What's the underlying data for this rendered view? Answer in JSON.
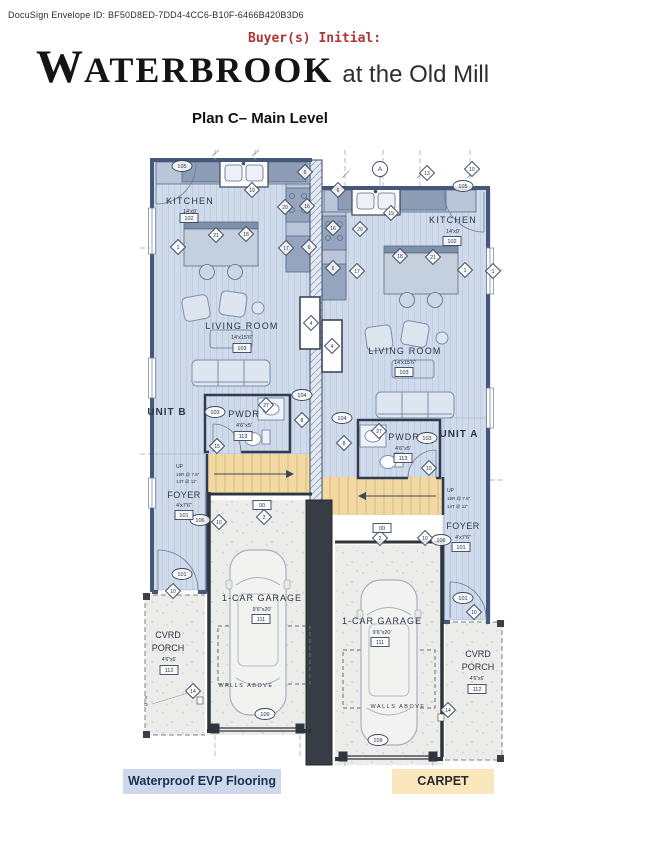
{
  "header": {
    "envelope_id": "DocuSign Envelope ID: BF50D8ED-7DD4-4CC6-B10F-6466B420B3D6",
    "buyer_initial_label": "Buyer(s) Initial:",
    "brand_initial": "W",
    "brand_rest": "ATERBROOK",
    "brand_subtitle": "at the Old Mill",
    "plan_title": "Plan C– Main Level"
  },
  "legend": {
    "evp_label": "Waterproof EVP Flooring",
    "carpet_label": "CARPET"
  },
  "colors": {
    "evp_floor": "#cfdaea",
    "carpet_stairs": "#f2d9a2",
    "legend_evp_bg": "#ccd9ed",
    "legend_carpet_bg": "#fbe7bd",
    "accent_red": "#b13434",
    "wall": "#46587a",
    "garage_wall": "#30343c"
  },
  "plan": {
    "texts": [
      {
        "x": 190,
        "y": 56,
        "t": "KITCHEN",
        "fs": 9,
        "ls": 1.2
      },
      {
        "x": 190,
        "y": 65,
        "t": "14'x9'",
        "fs": 5.5
      },
      {
        "x": 242,
        "y": 181,
        "t": "LIVING ROOM",
        "fs": 9,
        "ls": 1.2
      },
      {
        "x": 242,
        "y": 191,
        "t": "14'x15'6\"",
        "fs": 5.5
      },
      {
        "x": 167,
        "y": 267,
        "t": "UNIT B",
        "fs": 10,
        "w": "b",
        "ls": 1
      },
      {
        "x": 244,
        "y": 269,
        "t": "PWDR",
        "fs": 9,
        "ls": 1
      },
      {
        "x": 244,
        "y": 279,
        "t": "4'6\"x5'",
        "fs": 5.5
      },
      {
        "x": 176,
        "y": 320,
        "t": "UP",
        "fs": 5,
        "a": "s"
      },
      {
        "x": 176,
        "y": 328,
        "t": "15R @ 7.5\"",
        "fs": 4.5,
        "a": "s"
      },
      {
        "x": 176,
        "y": 335,
        "t": "14T @ 11\"",
        "fs": 4.5,
        "a": "s"
      },
      {
        "x": 184,
        "y": 350,
        "t": "FOYER",
        "fs": 9,
        "ls": 0.5
      },
      {
        "x": 184,
        "y": 359,
        "t": "4'x7'6\"",
        "fs": 5.5
      },
      {
        "x": 262,
        "y": 453,
        "t": "1-CAR GARAGE",
        "fs": 9,
        "ls": 1
      },
      {
        "x": 262,
        "y": 463,
        "t": "9'6\"x20'",
        "fs": 5.5
      },
      {
        "x": 168,
        "y": 490,
        "t": "CVRD",
        "fs": 9
      },
      {
        "x": 168,
        "y": 503,
        "t": "PORCH",
        "fs": 9
      },
      {
        "x": 169,
        "y": 513,
        "t": "4'6\"x6'",
        "fs": 5
      },
      {
        "x": 246,
        "y": 539,
        "t": "WALLS ABOVE",
        "fs": 5.5,
        "c": "#6d7278",
        "ls": 1.5
      },
      {
        "x": 146,
        "y": 551,
        "t": "X",
        "fs": 4.5,
        "c": "#555"
      },
      {
        "x": 146,
        "y": 558,
        "t": "D",
        "fs": 4.5,
        "c": "#555"
      },
      {
        "x": 453,
        "y": 75,
        "t": "KITCHEN",
        "fs": 9,
        "ls": 1.2
      },
      {
        "x": 453,
        "y": 85,
        "t": "14'x9'",
        "fs": 5.5
      },
      {
        "x": 405,
        "y": 206,
        "t": "LIVING ROOM",
        "fs": 9,
        "ls": 1.2
      },
      {
        "x": 405,
        "y": 216,
        "t": "14'x15'6\"",
        "fs": 5.5
      },
      {
        "x": 459,
        "y": 289,
        "t": "UNIT A",
        "fs": 10,
        "w": "b",
        "ls": 1
      },
      {
        "x": 404,
        "y": 292,
        "t": "PWDR",
        "fs": 9,
        "ls": 1
      },
      {
        "x": 403,
        "y": 302,
        "t": "4'6\"x5'",
        "fs": 5.5
      },
      {
        "x": 447,
        "y": 344,
        "t": "UP",
        "fs": 5,
        "a": "s"
      },
      {
        "x": 447,
        "y": 352,
        "t": "15R @ 7.5\"",
        "fs": 4.5,
        "a": "s"
      },
      {
        "x": 447,
        "y": 360,
        "t": "14T @ 11\"",
        "fs": 4.5,
        "a": "s"
      },
      {
        "x": 463,
        "y": 381,
        "t": "FOYER",
        "fs": 9,
        "ls": 0.5
      },
      {
        "x": 463,
        "y": 391,
        "t": "4'x7'6\"",
        "fs": 5.5
      },
      {
        "x": 382,
        "y": 476,
        "t": "1-CAR GARAGE",
        "fs": 9,
        "ls": 1
      },
      {
        "x": 382,
        "y": 486,
        "t": "9'6\"x20'",
        "fs": 5.5
      },
      {
        "x": 478,
        "y": 509,
        "t": "CVRD",
        "fs": 9
      },
      {
        "x": 478,
        "y": 522,
        "t": "PORCH",
        "fs": 9
      },
      {
        "x": 477,
        "y": 532,
        "t": "4'6\"x6'",
        "fs": 5
      },
      {
        "x": 398,
        "y": 560,
        "t": "WALLS ABOVE",
        "fs": 5.5,
        "c": "#6d7278",
        "ls": 1.5
      }
    ],
    "markers": [
      {
        "s": "o",
        "x": 182,
        "y": 18,
        "l": "105"
      },
      {
        "s": "o",
        "x": 302,
        "y": 247,
        "l": "104"
      },
      {
        "s": "o",
        "x": 215,
        "y": 264,
        "l": "103"
      },
      {
        "s": "o",
        "x": 200,
        "y": 372,
        "l": "106"
      },
      {
        "s": "o",
        "x": 182,
        "y": 426,
        "l": "101"
      },
      {
        "s": "o",
        "x": 265,
        "y": 566,
        "l": "109"
      },
      {
        "s": "o",
        "x": 463,
        "y": 38,
        "l": "105"
      },
      {
        "s": "o",
        "x": 342,
        "y": 270,
        "l": "104"
      },
      {
        "s": "o",
        "x": 427,
        "y": 290,
        "l": "103"
      },
      {
        "s": "o",
        "x": 441,
        "y": 392,
        "l": "106"
      },
      {
        "s": "o",
        "x": 463,
        "y": 450,
        "l": "101"
      },
      {
        "s": "o",
        "x": 378,
        "y": 592,
        "l": "109"
      },
      {
        "s": "c",
        "x": 380,
        "y": 21,
        "l": "A"
      },
      {
        "s": "d",
        "x": 305,
        "y": 24,
        "l": "6"
      },
      {
        "s": "d",
        "x": 252,
        "y": 42,
        "l": "19"
      },
      {
        "s": "d",
        "x": 285,
        "y": 59,
        "l": "20"
      },
      {
        "s": "d",
        "x": 307,
        "y": 58,
        "l": "16"
      },
      {
        "s": "d",
        "x": 216,
        "y": 87,
        "l": "21"
      },
      {
        "s": "d",
        "x": 246,
        "y": 86,
        "l": "18"
      },
      {
        "s": "d",
        "x": 178,
        "y": 99,
        "l": "1"
      },
      {
        "s": "d",
        "x": 286,
        "y": 100,
        "l": "17"
      },
      {
        "s": "d",
        "x": 309,
        "y": 99,
        "l": "6"
      },
      {
        "s": "d",
        "x": 311,
        "y": 175,
        "l": "4"
      },
      {
        "s": "d",
        "x": 266,
        "y": 257,
        "l": "27"
      },
      {
        "s": "d",
        "x": 302,
        "y": 272,
        "l": "8"
      },
      {
        "s": "d",
        "x": 217,
        "y": 298,
        "l": "15"
      },
      {
        "s": "d",
        "x": 264,
        "y": 369,
        "l": "2"
      },
      {
        "s": "d",
        "x": 219,
        "y": 374,
        "l": "10"
      },
      {
        "s": "d",
        "x": 173,
        "y": 443,
        "l": "10"
      },
      {
        "s": "d",
        "x": 193,
        "y": 543,
        "l": "14"
      },
      {
        "s": "d",
        "x": 427,
        "y": 25,
        "l": "13"
      },
      {
        "s": "d",
        "x": 472,
        "y": 21,
        "l": "10"
      },
      {
        "s": "d",
        "x": 338,
        "y": 42,
        "l": "6"
      },
      {
        "s": "d",
        "x": 391,
        "y": 65,
        "l": "19"
      },
      {
        "s": "d",
        "x": 333,
        "y": 80,
        "l": "16"
      },
      {
        "s": "d",
        "x": 360,
        "y": 81,
        "l": "20"
      },
      {
        "s": "d",
        "x": 400,
        "y": 108,
        "l": "18"
      },
      {
        "s": "d",
        "x": 433,
        "y": 109,
        "l": "21"
      },
      {
        "s": "d",
        "x": 465,
        "y": 122,
        "l": "1"
      },
      {
        "s": "d",
        "x": 493,
        "y": 123,
        "l": "1"
      },
      {
        "s": "d",
        "x": 357,
        "y": 123,
        "l": "17"
      },
      {
        "s": "d",
        "x": 333,
        "y": 120,
        "l": "6"
      },
      {
        "s": "d",
        "x": 332,
        "y": 198,
        "l": "4"
      },
      {
        "s": "d",
        "x": 379,
        "y": 283,
        "l": "27"
      },
      {
        "s": "d",
        "x": 344,
        "y": 295,
        "l": "8"
      },
      {
        "s": "d",
        "x": 429,
        "y": 320,
        "l": "15"
      },
      {
        "s": "d",
        "x": 380,
        "y": 390,
        "l": "2"
      },
      {
        "s": "d",
        "x": 425,
        "y": 390,
        "l": "10"
      },
      {
        "s": "d",
        "x": 474,
        "y": 464,
        "l": "10"
      },
      {
        "s": "d",
        "x": 448,
        "y": 562,
        "l": "14"
      },
      {
        "s": "b",
        "x": 189,
        "y": 70,
        "l": "102"
      },
      {
        "s": "b",
        "x": 242,
        "y": 200,
        "l": "103"
      },
      {
        "s": "b",
        "x": 243,
        "y": 288,
        "l": "113"
      },
      {
        "s": "b",
        "x": 184,
        "y": 367,
        "l": "101"
      },
      {
        "s": "b",
        "x": 261,
        "y": 471,
        "l": "111"
      },
      {
        "s": "b",
        "x": 169,
        "y": 522,
        "l": "112"
      },
      {
        "s": "b",
        "x": 262,
        "y": 357,
        "l": "00"
      },
      {
        "s": "b",
        "x": 452,
        "y": 93,
        "l": "102"
      },
      {
        "s": "b",
        "x": 404,
        "y": 224,
        "l": "103"
      },
      {
        "s": "b",
        "x": 403,
        "y": 310,
        "l": "113"
      },
      {
        "s": "b",
        "x": 461,
        "y": 399,
        "l": "101"
      },
      {
        "s": "b",
        "x": 380,
        "y": 494,
        "l": "111"
      },
      {
        "s": "b",
        "x": 477,
        "y": 541,
        "l": "112"
      },
      {
        "s": "b",
        "x": 382,
        "y": 380,
        "l": "00"
      }
    ]
  }
}
